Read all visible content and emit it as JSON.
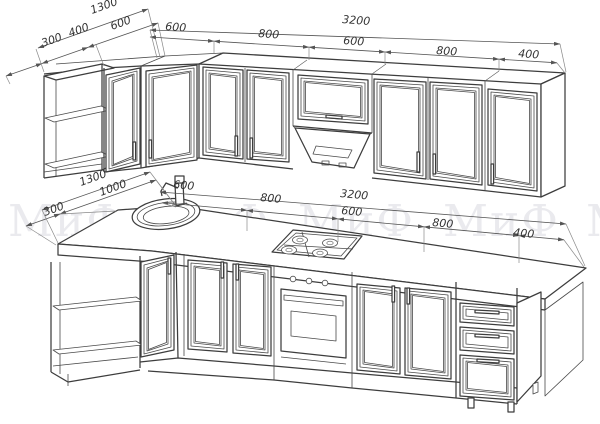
{
  "drawing": {
    "type": "kitchen-furniture-technical-drawing",
    "background_color": "#ffffff",
    "line_color": "#3d3d3d",
    "watermark_color": "#eaeaee"
  },
  "watermark": {
    "text": "МиФ",
    "repeats": [
      "МиФ",
      "МиФ",
      "МиФ",
      "МиФ",
      "МиФ"
    ]
  },
  "dims": {
    "upper_leg": {
      "overall": "1300",
      "segments": [
        "300",
        "400",
        "600"
      ]
    },
    "upper_front": {
      "overall": "3200",
      "segments": [
        "600",
        "800",
        "600",
        "800",
        "400"
      ]
    },
    "lower_leg": {
      "overall": "1300",
      "segments": [
        "300",
        "1000"
      ]
    },
    "lower_front": {
      "overall": "3200",
      "segments": [
        "600",
        "800",
        "600",
        "800",
        "400"
      ]
    }
  },
  "scene_items": {
    "upper_row": [
      "open-corner-shelf",
      "glass-lattice-door-400",
      "corner-lattice-door-600",
      "double-lattice-doors-800",
      "hood-cabinet-600-with-extractor",
      "double-lattice-doors-800",
      "lattice-door-400"
    ],
    "lower_row": [
      "open-corner-shelf",
      "corner-sink-cabinet",
      "double-lattice-doors-800",
      "oven-with-gas-hob-600",
      "double-lattice-doors-800",
      "drawer-unit-400"
    ]
  }
}
